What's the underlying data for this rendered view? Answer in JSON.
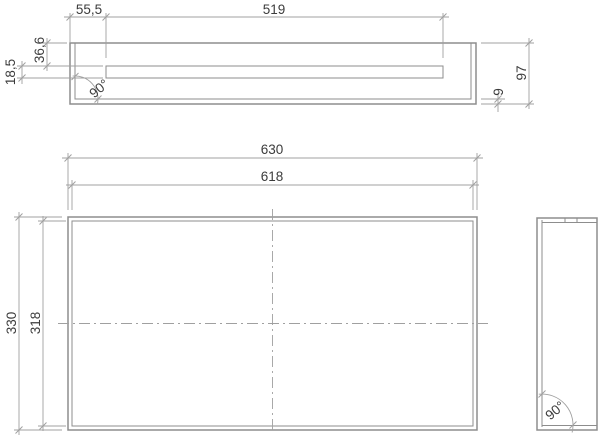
{
  "figure": {
    "type": "technical-drawing-three-views",
    "colors": {
      "object_line": "#8d8d8d",
      "dimension_line": "#a0a0a0",
      "text": "#3c3c3c",
      "background": "#ffffff"
    },
    "views": {
      "top": {
        "label": "top-view",
        "dims": {
          "slot_offset_left": "55,5",
          "slot_length": "519",
          "slot_offset_back": "36,6",
          "slot_width": "18,5",
          "corner_angle": "90°",
          "depth": "97",
          "front_thickness": "9"
        }
      },
      "front": {
        "label": "front-view",
        "dims": {
          "outer_width": "630",
          "inner_width": "618",
          "outer_height": "330",
          "inner_height": "318"
        }
      },
      "side": {
        "label": "side-view",
        "dims": {
          "corner_angle": "90°"
        }
      }
    }
  }
}
